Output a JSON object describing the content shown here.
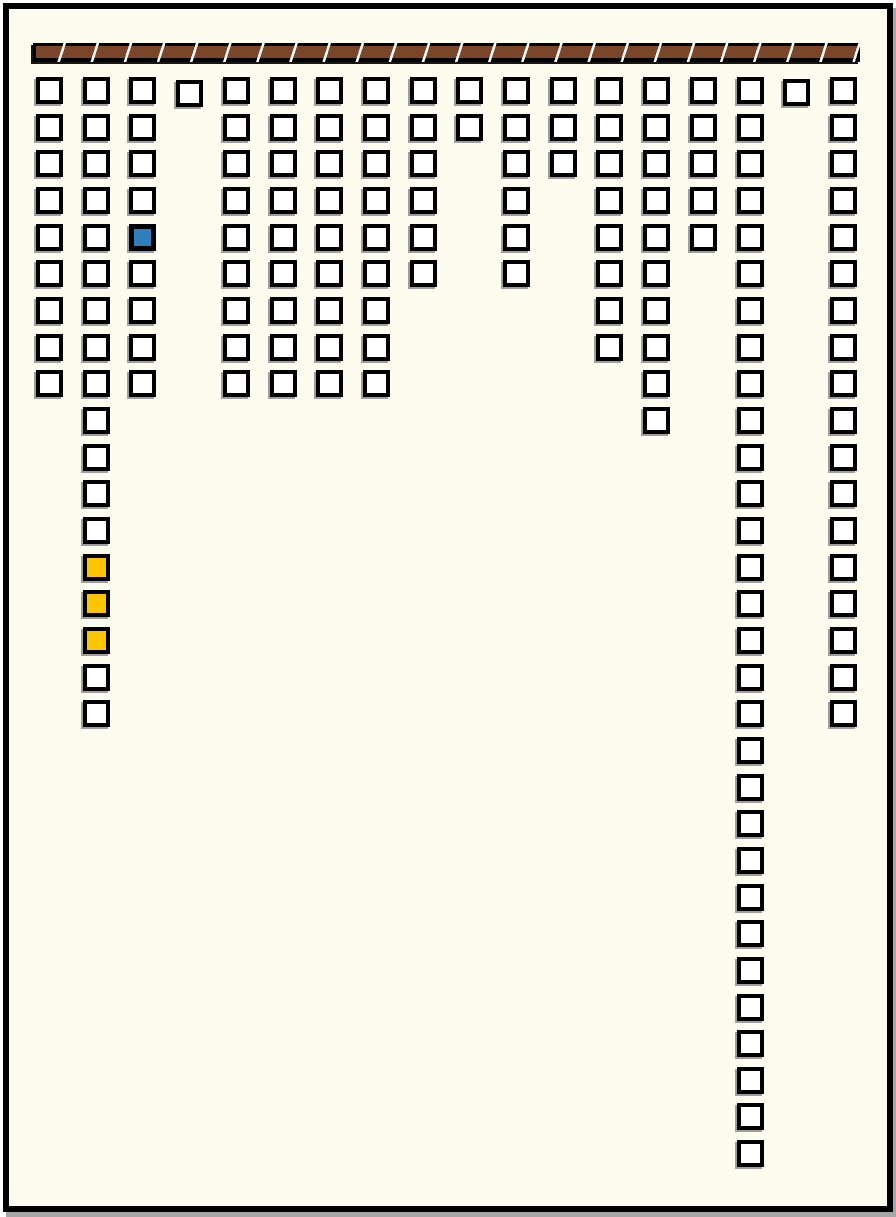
{
  "board": {
    "colors": {
      "canvas": "#FCFCEF",
      "frame": "#000000",
      "frame_shadow": "#A6A6A6",
      "bar_fill": "#7B4529",
      "bar_hatch": "#FFFFFF",
      "bar_border": "#000000",
      "cell_fill": "#FFFFFF",
      "cell_border": "#000000",
      "cell_shadow": "#9E9E9E",
      "blue": "#2F80BA",
      "yellow": "#FDC500"
    },
    "columns": [
      {
        "index": 1,
        "cells": 9
      },
      {
        "index": 2,
        "cells": 18,
        "highlights": [
          {
            "row": 14,
            "color": "yellow"
          },
          {
            "row": 15,
            "color": "yellow"
          },
          {
            "row": 16,
            "color": "yellow"
          }
        ]
      },
      {
        "index": 3,
        "cells": 9,
        "highlights": [
          {
            "row": 5,
            "color": "blue"
          }
        ]
      },
      {
        "index": 4,
        "cells": 1,
        "y_offset": 3
      },
      {
        "index": 5,
        "cells": 9
      },
      {
        "index": 6,
        "cells": 9
      },
      {
        "index": 7,
        "cells": 9
      },
      {
        "index": 8,
        "cells": 9
      },
      {
        "index": 9,
        "cells": 6
      },
      {
        "index": 10,
        "cells": 2
      },
      {
        "index": 11,
        "cells": 6
      },
      {
        "index": 12,
        "cells": 3
      },
      {
        "index": 13,
        "cells": 8
      },
      {
        "index": 14,
        "cells": 10
      },
      {
        "index": 15,
        "cells": 5
      },
      {
        "index": 16,
        "cells": 30
      },
      {
        "index": 17,
        "cells": 1,
        "y_offset": 2
      },
      {
        "index": 18,
        "cells": 18
      }
    ]
  }
}
